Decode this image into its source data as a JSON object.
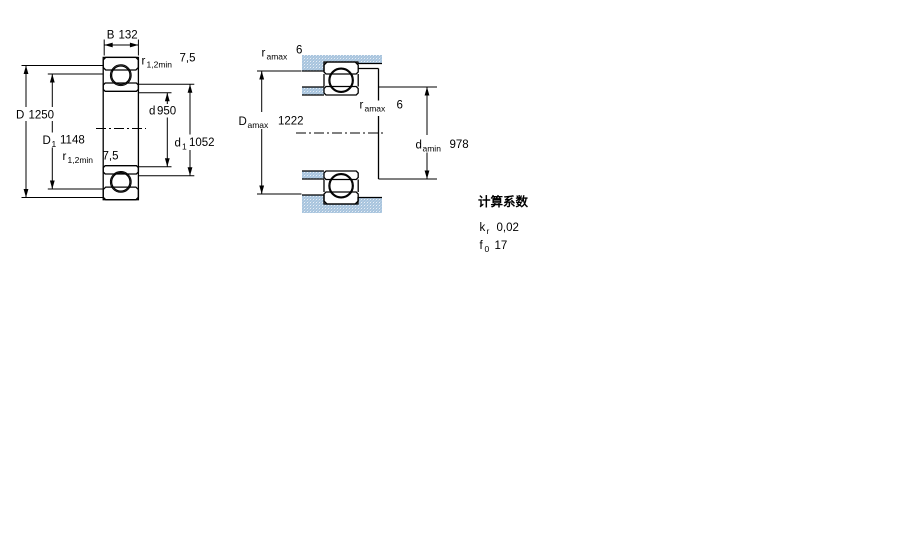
{
  "section_view": {
    "b": {
      "label": "B",
      "sub": "",
      "value": "132"
    },
    "r_top": {
      "label": "r",
      "sub": "1,2min",
      "value": "7,5"
    },
    "r_bot": {
      "label": "r",
      "sub": "1,2min",
      "value": "7,5"
    },
    "D": {
      "label": "D",
      "sub": "",
      "value": "1250"
    },
    "D1": {
      "label": "D",
      "sub": "1",
      "value": "1148"
    },
    "d": {
      "label": "d",
      "sub": "",
      "value": "950"
    },
    "d1": {
      "label": "d",
      "sub": "1",
      "value": "1052"
    }
  },
  "mounting_view": {
    "ra_top": {
      "label": "r",
      "sub": "amax",
      "value": "6"
    },
    "ra_mid": {
      "label": "r",
      "sub": "amax",
      "value": "6"
    },
    "Da": {
      "label": "D",
      "sub": "amax",
      "value": "1222"
    },
    "da": {
      "label": "d",
      "sub": "amin",
      "value": "978"
    }
  },
  "calculation_factors": {
    "title": "计算系数",
    "kr": {
      "label": "k",
      "sub": "r",
      "value": "0,02"
    },
    "f0": {
      "label": "f",
      "sub": "0",
      "value": "17"
    }
  },
  "colors": {
    "hatch_blue": "#a9c5de",
    "hatch_light": "#e7eef6",
    "line": "#000000",
    "background": "#ffffff"
  }
}
